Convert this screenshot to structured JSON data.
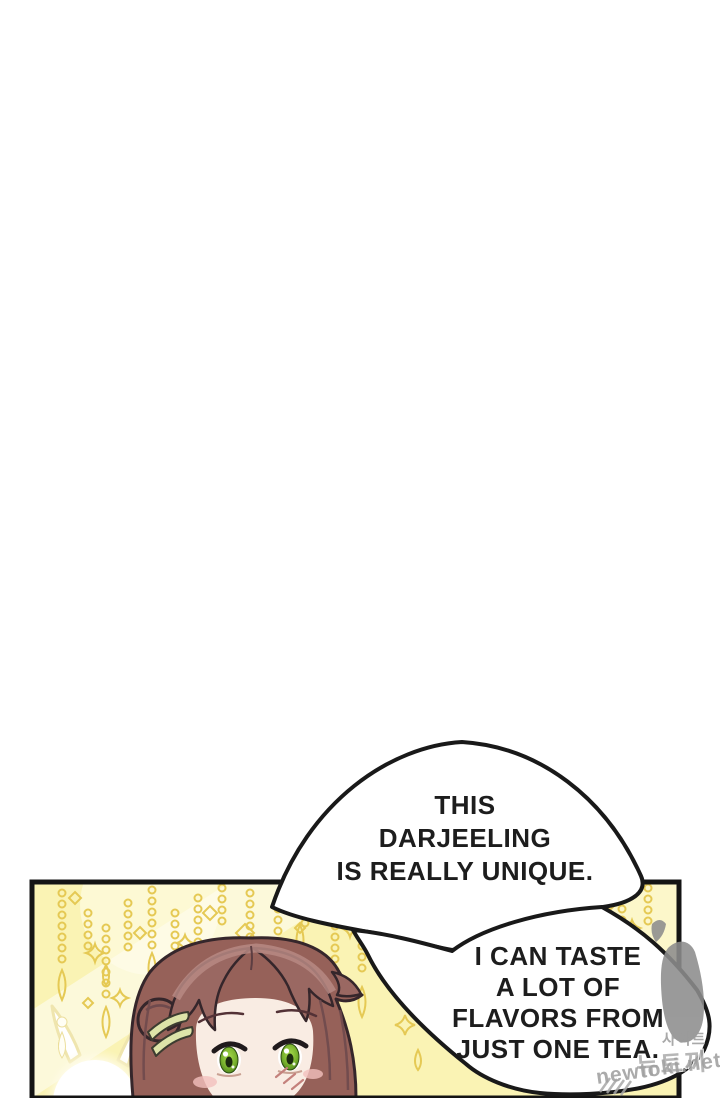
{
  "page": {
    "kind": "webtoon comic page",
    "background_color": "#ffffff"
  },
  "speech_bubbles": [
    {
      "id": "bubble-1",
      "lines": [
        "THIS",
        "DARJEELING",
        "IS REALLY UNIQUE."
      ]
    },
    {
      "id": "bubble-2",
      "lines": [
        "I CAN TASTE",
        "A LOT OF",
        "FLAVORS FROM",
        "JUST ONE TEA."
      ]
    }
  ],
  "panel": {
    "background_color": "#faf3b4",
    "ornament_color": "#e5c954",
    "border_color": "#141414",
    "character": {
      "hair_color": "#966159",
      "eye_color": "#7ab32e",
      "skin_color": "#f9ece3",
      "hair_clip_color": "#dde4a9"
    }
  },
  "watermark": {
    "site_label_korean": "사이트",
    "site_name_korean": "뉴토끼",
    "site_url": "newtoki.net",
    "color": "#9b9b9b"
  }
}
